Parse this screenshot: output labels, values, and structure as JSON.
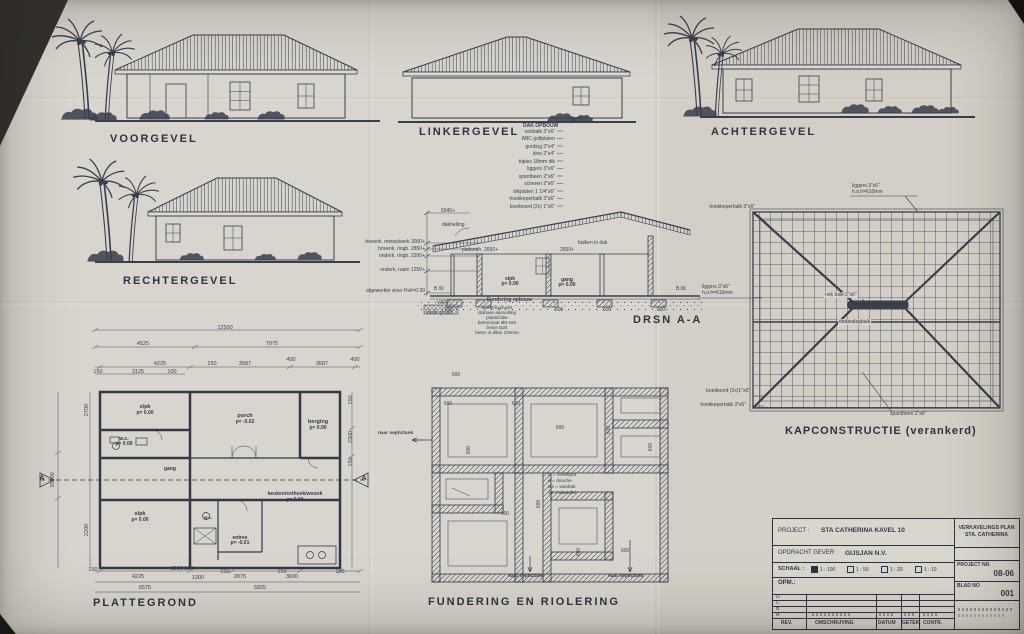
{
  "panels": {
    "voorgevel": {
      "title": "VOORGEVEL"
    },
    "linkergevel": {
      "title": "LINKERGEVEL"
    },
    "achtergevel": {
      "title": "ACHTERGEVEL"
    },
    "rechtergevel": {
      "title": "RECHTERGEVEL"
    },
    "doorsnede": {
      "title": "DRSN A-A"
    },
    "kap": {
      "title": "KAPCONSTRUCTIE (verankerd)"
    },
    "plattegrond": {
      "title": "PLATTEGROND"
    },
    "fundering": {
      "title": "FUNDERING EN RIOLERING"
    }
  },
  "dak_opbouw": {
    "title": "DAK OPBOUW",
    "items": [
      "nokbalk 3\"x6\"",
      "ABC golfplaten",
      "gording 2\"x4\"",
      "kloe 2\"x4\"",
      "triplex 18mm dik",
      "liggers 3\"x6\"",
      "spantbeen 2\"x6\"",
      "scheren 2\"x6\"",
      "trikplaten 1 1/4\"x6\"",
      "hoekkeperbalk 3\"x6\"",
      "boeiboord (2x) 1\"x6\""
    ]
  },
  "section": {
    "top_height": "5045+",
    "slope_label": "dakhelling",
    "left_marks": [
      "bovenk. metselwerk  3000+",
      "bovenk. ringb.  2850+",
      "onderk. ringb.  2200+",
      "onderk. raam  1250+",
      "afgewerkte vloer  Peil=0.00"
    ],
    "plafond": "plafondh. 2650+",
    "plafond2": "2650+",
    "balken": "balken in dak",
    "room1": "slpk",
    "room1_p": "p= 0.00",
    "room2": "gang",
    "room2_p": "p= 0.00",
    "bw": "B.W.",
    "var": "VAR.",
    "vaste_grond": "vaste grond",
    "found_title": "Fundering opbouw",
    "found_items": [
      "funderingsvoet",
      "diabase aanvulling",
      "plasticfolie",
      "betonmaat Ø8-150",
      "beton B25",
      "beton vl.dikte 100mm"
    ],
    "dim600": "600"
  },
  "kap_labels": {
    "hoekkeper_top": "hoekkeperbalk 3\"x6\"",
    "liggers_top": "liggers 3\"x6\"",
    "liggers_top2": "h.o.h=610mm",
    "liggers_left": "liggers 3\"x6\"",
    "liggers_left2": "h.o.h=610mm",
    "nokbalk": "nok balk 3\"x6\"",
    "onderslag": "onderslagbalk",
    "boeiboord": "boeiboord (2x)1\"x6\"",
    "hoekkeper_bottom": "hoekkeperbalk 3\"x6\"",
    "spantbeen": "spantbeen 2\"x6\""
  },
  "plattegrond": {
    "marker": "A",
    "rooms": [
      {
        "name": "slpk",
        "p": "p= 0.00"
      },
      {
        "name": "w.c.",
        "p": "p= 0.00"
      },
      {
        "name": "gang",
        "p": ""
      },
      {
        "name": "porch",
        "p": "p= -0.02"
      },
      {
        "name": "berging",
        "p": "p= 0.00"
      },
      {
        "name": "slpk",
        "p": "p= 0.00"
      },
      {
        "name": "w.c.",
        "p": ""
      },
      {
        "name": "entree",
        "p": "p= -0.01"
      },
      {
        "name": "keuken/eethoek/woonk",
        "p": "p= 0.00"
      }
    ],
    "dims_top": [
      "12500",
      "4525",
      "7975",
      "4225",
      "150",
      "3587",
      "400",
      "3587",
      "400",
      "150",
      "3125",
      "100"
    ],
    "dims_bottom": [
      "150",
      "4225",
      "1000 100",
      "1300",
      "150",
      "2875",
      "150",
      "3600",
      "150",
      "6575",
      "5925"
    ],
    "dims_left": [
      "2700",
      "10000",
      "2200"
    ],
    "dims_right": [
      "150",
      "2300",
      "150"
    ]
  },
  "fundering": {
    "dim": "600",
    "legend": [
      "cl = closetpot",
      "d = douche",
      "ws = wasbak",
      "wt = wastafel"
    ],
    "septic": "naar septictank"
  },
  "titleblock": {
    "project_label": "PROJECT :",
    "project_value": "STA CATHERINA KAVEL 10",
    "client_label": "OPDRACHT GEVER :",
    "client_value": "GIJSJAN N.V.",
    "schaal_label": "SCHAAL :",
    "scales": [
      "1 : 100",
      "1 : 50",
      "1 : 20",
      "1 : 10"
    ],
    "opm_label": "OPM.:",
    "rev_rows": [
      "D",
      "C",
      "B",
      "A"
    ],
    "footer": [
      "REV.",
      "OMSCHRIJVING",
      "DATUM",
      "GETEK.",
      "CONTR."
    ],
    "plan_title1": "VERKAVELINGS PLAN",
    "plan_title2": "STA. CATHERINA",
    "projectnr_label": "PROJECT NR.",
    "projectnr_value": "08-06",
    "blad_label": "BLAD NO",
    "blad_value": "001"
  }
}
